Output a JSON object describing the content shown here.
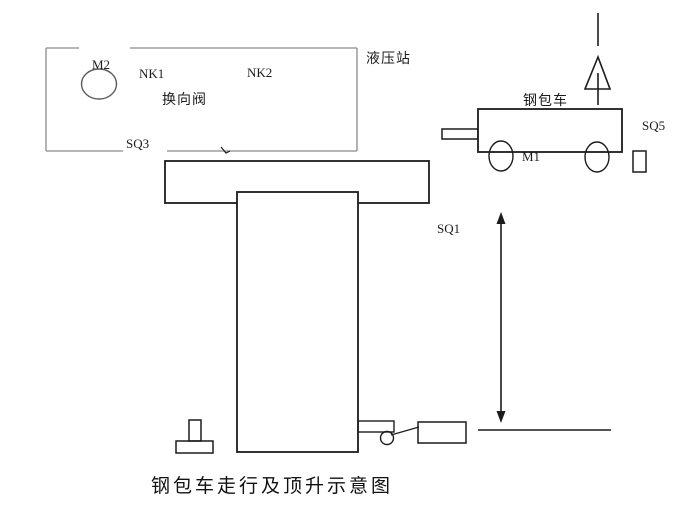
{
  "diagram": {
    "title": "钢包车走行及顶升示意图",
    "labels": {
      "m2": "M2",
      "nk1": "NK1",
      "nk2": "NK2",
      "valve": "换向阀",
      "sq3": "SQ3",
      "station": "液压站",
      "car": "钢包车",
      "m1": "M1",
      "sq5": "SQ5",
      "sq1": "SQ1"
    },
    "colors": {
      "main_line": "#1c1c1c",
      "station_line": "#8a8a8a",
      "motor_circle": "#5a5a5a",
      "background": "#ffffff",
      "text": "#1c1c1c"
    }
  }
}
